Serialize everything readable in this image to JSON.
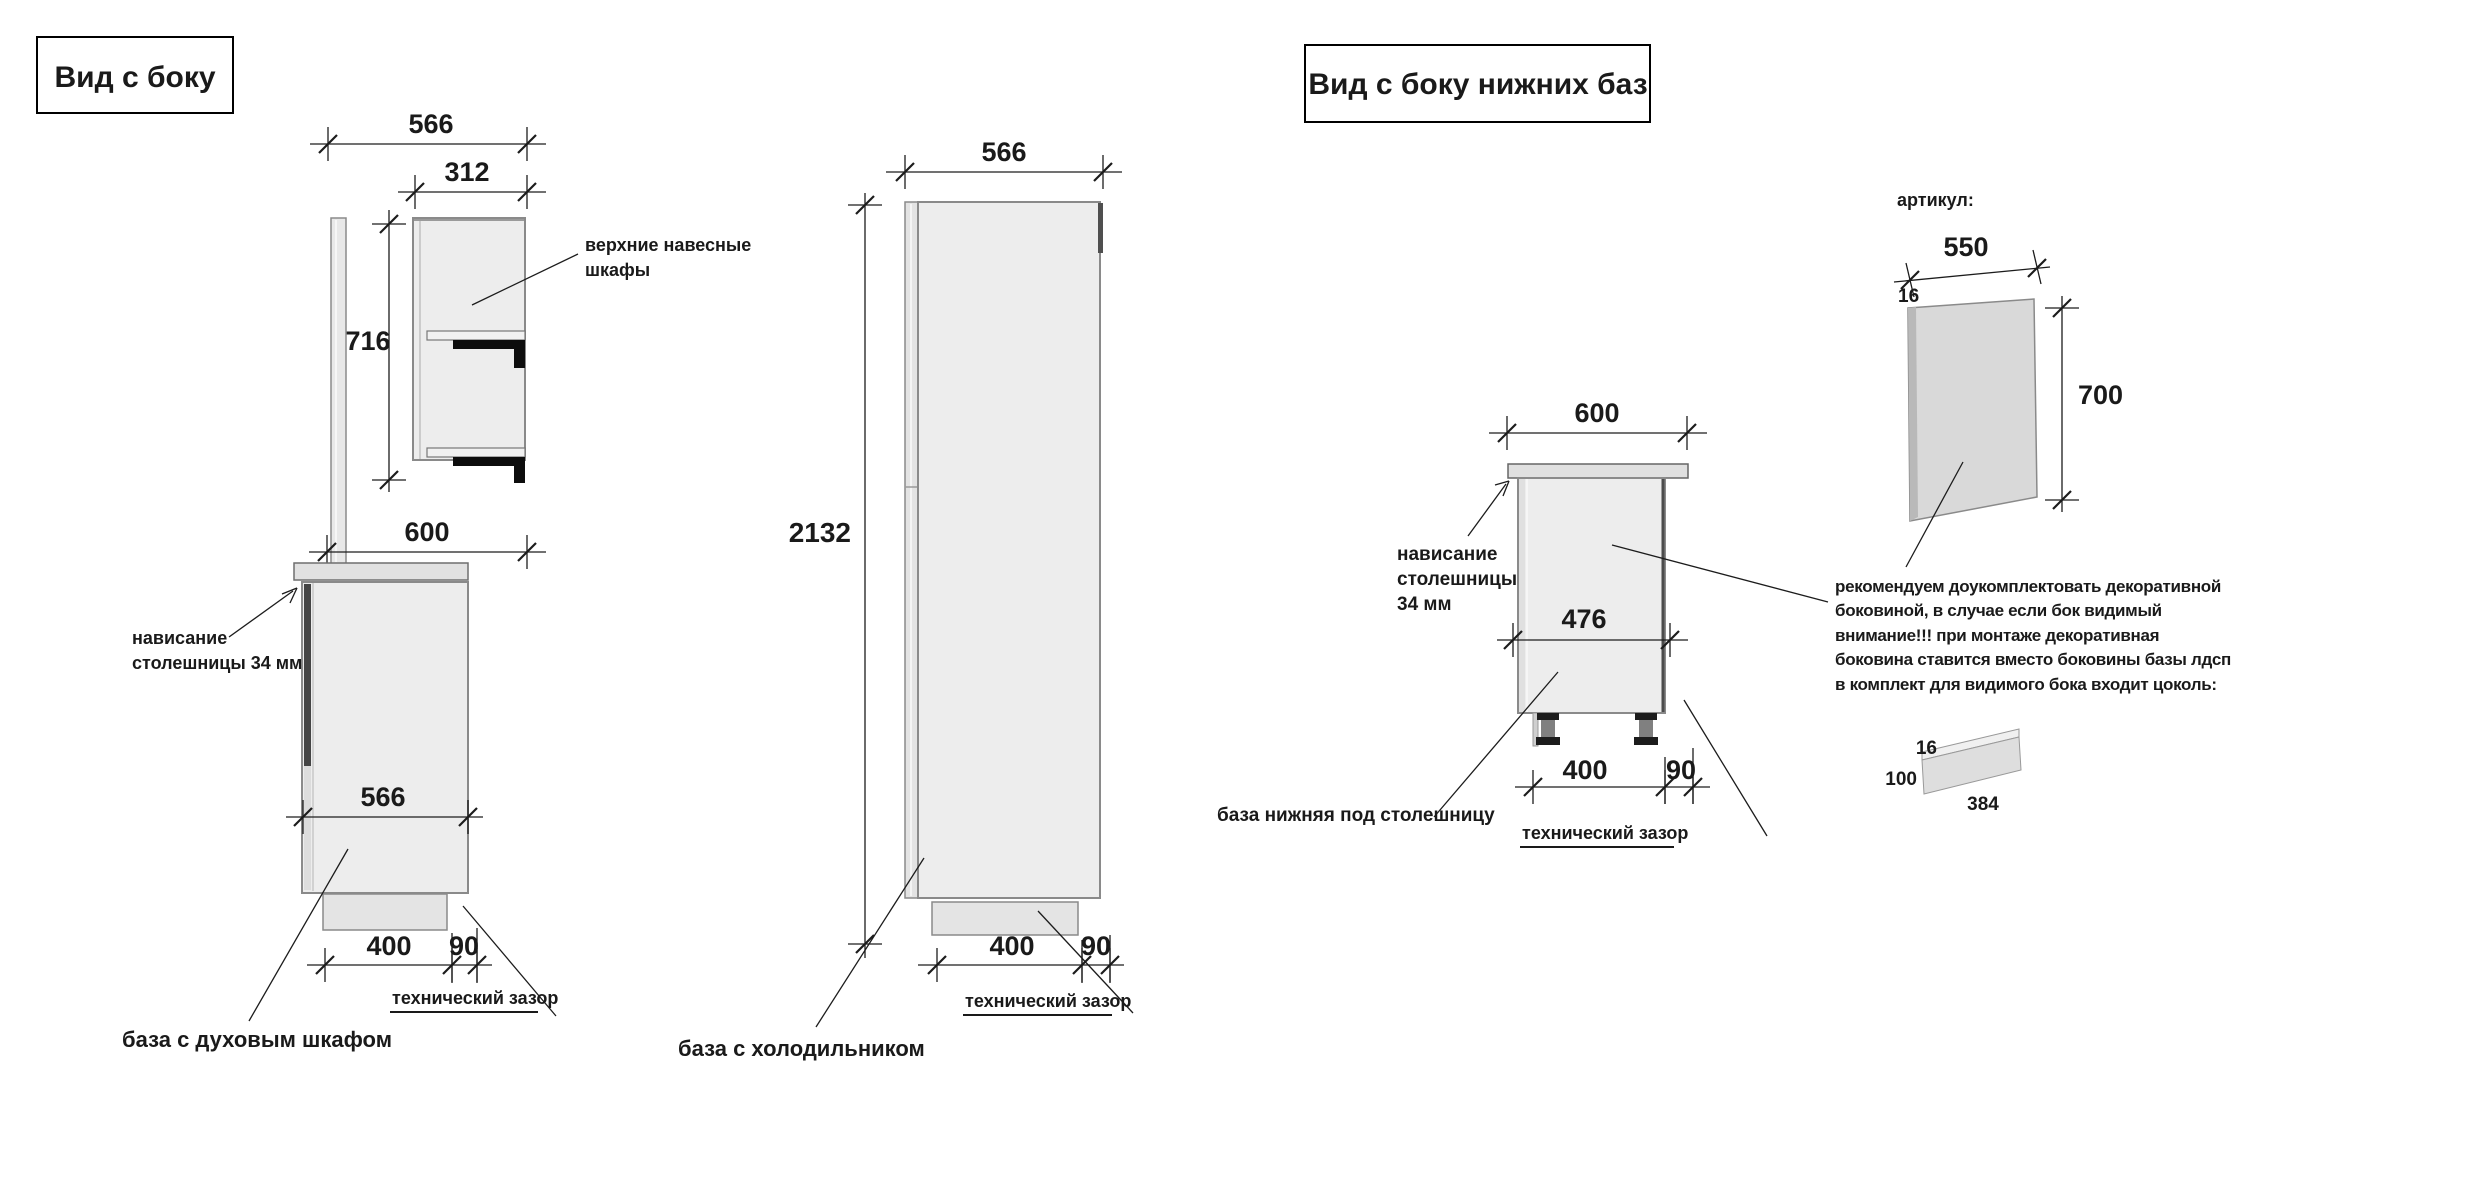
{
  "colors": {
    "accent_red": "#b04a45",
    "text_black": "#1a1a1a",
    "cabinet_fill": "#ededed",
    "cabinet_edge": "#8a8a8a"
  },
  "left_view": {
    "title": "Вид с боку",
    "caption": "база с духовым шкафом",
    "dims": {
      "top_width": "566",
      "upper_depth": "312",
      "upper_height": "716",
      "countertop_width": "600",
      "base_depth": "566",
      "plinth_depth": "400",
      "tech_gap": "90"
    },
    "labels": {
      "wall_cabinets_line1": "верхние навесные",
      "wall_cabinets_line2": "шкафы",
      "overhang_line1": "нависание",
      "overhang_line2": "столешницы 34 мм",
      "tech_gap": "технический зазор"
    }
  },
  "middle_view": {
    "caption": "база с холодильником",
    "dims": {
      "top_width": "566",
      "height": "2132",
      "plinth_depth": "400",
      "tech_gap": "90"
    },
    "labels": {
      "tech_gap": "технический зазор"
    }
  },
  "right_view": {
    "title": "Вид с боку нижних баз",
    "caption": "база нижняя под столешницу",
    "dims": {
      "top_width": "600",
      "inner_depth": "476",
      "plinth_depth": "400",
      "tech_gap": "90"
    },
    "labels": {
      "overhang_line1": "нависание",
      "overhang_line2": "столешницы",
      "overhang_line3": "34 мм",
      "tech_gap": "технический зазор"
    }
  },
  "side_panel_detail": {
    "sku_label": "артикул:",
    "dims": {
      "width": "550",
      "thickness": "16",
      "height": "700"
    },
    "note_line1": "рекомендуем доукомплектовать декоративной",
    "note_line2": "боковиной, в случае если бок видимый",
    "warning_line1": "внимание!!! при монтаже декоративная",
    "warning_line2": "боковина ставится вместо боковины базы лдсп",
    "note_line3": "в комплект для видимого бока входит цоколь:",
    "plinth": {
      "thickness": "16",
      "height": "100",
      "length": "384"
    }
  }
}
